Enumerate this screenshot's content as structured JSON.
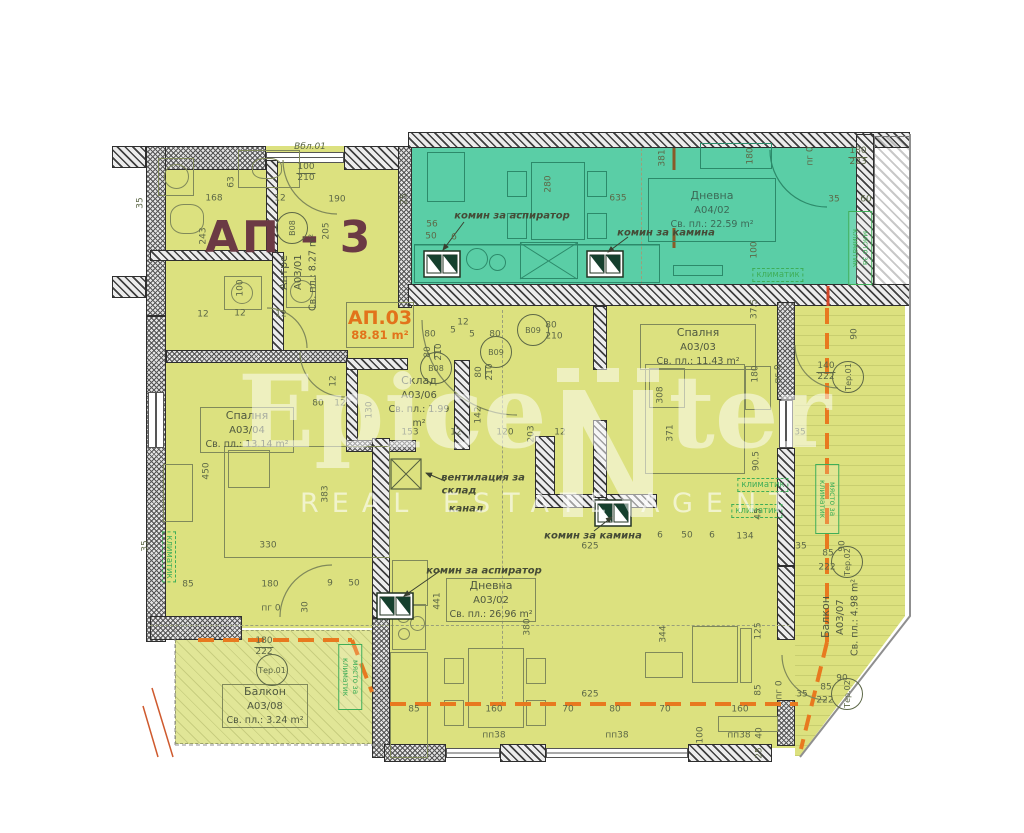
{
  "plan": {
    "building_label": "АП - 3",
    "unit_box": {
      "id": "АП.03",
      "area": "88.81 m²"
    },
    "rooms": [
      {
        "name": "Дневна",
        "code": "A04/02",
        "area": "Св. пл.: 22.59 m²"
      },
      {
        "name": "Антре",
        "code": "A03/01",
        "area": "Св. пл.: 8.27 m²"
      },
      {
        "name": "Спалня",
        "code": "A03/04",
        "area": "Св. пл.: 13.14 m²"
      },
      {
        "name": "Спалня",
        "code": "A03/03",
        "area": "Св. пл.: 11.43 m²"
      },
      {
        "name": "Склад",
        "code": "A03/06",
        "area": "Св. пл.: 1.99 m²"
      },
      {
        "name": "Дневна",
        "code": "A03/02",
        "area": "Св. пл.: 26.96 m²"
      },
      {
        "name": "Балкон",
        "code": "A03/08",
        "area": "Св. пл.: 3.24 m²"
      },
      {
        "name": "Балкон",
        "code": "A03/07",
        "area": "Св. пл.: 4.98 m²"
      }
    ],
    "watermark": {
      "left": "Epice",
      "right": "ter",
      "sub": "REAL ESTATE AGENT"
    },
    "colors": {
      "unit_fill": "#dce17f",
      "neighbor_fill": "#5acea6",
      "boundary_orange": "#e8791f",
      "unit_label_orange": "#e2731b",
      "title_maroon": "#6b3a44",
      "annotation_green": "#3fae58"
    },
    "notes": [
      {
        "t": "комин за аспиратор",
        "x": 512,
        "y": 216,
        "k": "ann"
      },
      {
        "t": "комин за камина",
        "x": 666,
        "y": 233,
        "k": "ann"
      },
      {
        "t": "комин за камина",
        "x": 593,
        "y": 536,
        "k": "ann"
      },
      {
        "t": "комин за аспиратор",
        "x": 484,
        "y": 571,
        "k": "ann"
      },
      {
        "t": "вентилация за",
        "x": 483,
        "y": 478,
        "k": "ann"
      },
      {
        "t": "склад",
        "x": 459,
        "y": 491,
        "k": "ann"
      },
      {
        "t": "канал",
        "x": 466,
        "y": 509,
        "k": "ann"
      },
      {
        "t": "климатик",
        "x": 778,
        "y": 275,
        "k": "klim"
      },
      {
        "t": "климатик",
        "x": 763,
        "y": 485,
        "k": "klim"
      },
      {
        "t": "климатик",
        "x": 757,
        "y": 511,
        "k": "klim"
      },
      {
        "t": "климатик",
        "x": 169,
        "y": 557,
        "k": "klimv"
      },
      {
        "t": "място за климатик",
        "x": 860,
        "y": 248,
        "k": "mqsto",
        "h": 68
      },
      {
        "t": "място за климатик",
        "x": 827,
        "y": 499,
        "k": "mqsto",
        "h": 64
      },
      {
        "t": "място за климатик",
        "x": 350,
        "y": 677,
        "k": "mqsto",
        "h": 60
      }
    ],
    "markers": [
      {
        "t": "Вбл.01",
        "x": 310,
        "y": 147,
        "p": 1
      },
      {
        "t": "B08",
        "x": 292,
        "y": 228,
        "c": 1,
        "v": 1
      },
      {
        "t": "B08",
        "x": 436,
        "y": 368,
        "c": 1
      },
      {
        "t": "B09",
        "x": 533,
        "y": 330,
        "c": 1
      },
      {
        "t": "B09",
        "x": 496,
        "y": 352,
        "c": 1
      },
      {
        "t": "Тер.01",
        "x": 848,
        "y": 377,
        "c": 1,
        "v": 1
      },
      {
        "t": "Тер.01",
        "x": 272,
        "y": 670,
        "c": 1
      },
      {
        "t": "Тер.02",
        "x": 847,
        "y": 562,
        "c": 1,
        "v": 1
      },
      {
        "t": "Тер.02",
        "x": 847,
        "y": 694,
        "c": 1,
        "v": 1
      }
    ],
    "dims": [
      {
        "t": "35",
        "x": 141,
        "y": 203,
        "v": 1
      },
      {
        "t": "168",
        "x": 214,
        "y": 199
      },
      {
        "t": "63",
        "x": 232,
        "y": 182,
        "v": 1
      },
      {
        "t": "12",
        "x": 280,
        "y": 199
      },
      {
        "t": "100",
        "t2": "210",
        "x": 306,
        "y": 173
      },
      {
        "t": "190",
        "x": 337,
        "y": 200
      },
      {
        "t": "205",
        "x": 327,
        "y": 231,
        "v": 1
      },
      {
        "t": "243",
        "x": 204,
        "y": 236,
        "v": 1
      },
      {
        "t": "100",
        "x": 241,
        "y": 288,
        "v": 1
      },
      {
        "t": "12",
        "x": 203,
        "y": 315
      },
      {
        "t": "12",
        "x": 240,
        "y": 314
      },
      {
        "t": "12",
        "x": 281,
        "y": 315
      },
      {
        "t": "25",
        "x": 405,
        "y": 199,
        "v": 1
      },
      {
        "t": "381",
        "x": 663,
        "y": 158,
        "v": 1
      },
      {
        "t": "280",
        "x": 549,
        "y": 184,
        "v": 1
      },
      {
        "t": "635",
        "x": 618,
        "y": 199
      },
      {
        "t": "180",
        "x": 751,
        "y": 156,
        "v": 1
      },
      {
        "t": "пг 0",
        "x": 811,
        "y": 156,
        "v": 1
      },
      {
        "t": "180",
        "t2": "223",
        "x": 858,
        "y": 157
      },
      {
        "t": "35",
        "x": 834,
        "y": 200
      },
      {
        "t": "60",
        "x": 866,
        "y": 200
      },
      {
        "t": "100",
        "x": 755,
        "y": 250,
        "v": 1
      },
      {
        "t": "56",
        "x": 432,
        "y": 225
      },
      {
        "t": "50",
        "x": 431,
        "y": 237
      },
      {
        "t": "6",
        "x": 454,
        "y": 238
      },
      {
        "t": "12",
        "x": 463,
        "y": 323
      },
      {
        "t": "80",
        "x": 430,
        "y": 335
      },
      {
        "t": "5",
        "x": 453,
        "y": 331
      },
      {
        "t": "5",
        "x": 472,
        "y": 335
      },
      {
        "t": "80",
        "x": 495,
        "y": 335
      },
      {
        "t": "80",
        "x": 551,
        "y": 326
      },
      {
        "t": "210",
        "x": 554,
        "y": 337
      },
      {
        "t": "80",
        "t2": "210",
        "x": 434,
        "y": 352,
        "v": 1
      },
      {
        "t": "80",
        "t2": "210",
        "x": 485,
        "y": 372,
        "v": 1
      },
      {
        "t": "130",
        "x": 370,
        "y": 410,
        "v": 1
      },
      {
        "t": "153",
        "x": 410,
        "y": 433
      },
      {
        "t": "12",
        "x": 456,
        "y": 433
      },
      {
        "t": "120",
        "x": 505,
        "y": 433
      },
      {
        "t": "203",
        "x": 532,
        "y": 434,
        "v": 1
      },
      {
        "t": "12",
        "x": 560,
        "y": 433
      },
      {
        "t": "142",
        "x": 479,
        "y": 415,
        "v": 1
      },
      {
        "t": "12",
        "x": 334,
        "y": 381,
        "v": 1
      },
      {
        "t": "80",
        "x": 318,
        "y": 404
      },
      {
        "t": "12",
        "x": 340,
        "y": 404
      },
      {
        "t": "37.5",
        "x": 755,
        "y": 309,
        "v": 1
      },
      {
        "t": "308",
        "x": 661,
        "y": 395,
        "v": 1
      },
      {
        "t": "371",
        "x": 671,
        "y": 433,
        "v": 1
      },
      {
        "t": "180",
        "x": 756,
        "y": 374,
        "v": 1
      },
      {
        "t": "90.5",
        "x": 757,
        "y": 461,
        "v": 1
      },
      {
        "t": "пг 0",
        "x": 779,
        "y": 374,
        "v": 1
      },
      {
        "t": "140",
        "t2": "222",
        "x": 826,
        "y": 372
      },
      {
        "t": "90",
        "x": 855,
        "y": 334,
        "v": 1
      },
      {
        "t": "35",
        "x": 800,
        "y": 433
      },
      {
        "t": "450",
        "x": 207,
        "y": 471,
        "v": 1
      },
      {
        "t": "383",
        "x": 326,
        "y": 494,
        "v": 1
      },
      {
        "t": "330",
        "x": 268,
        "y": 546
      },
      {
        "t": "85",
        "x": 188,
        "y": 585
      },
      {
        "t": "180",
        "x": 270,
        "y": 585
      },
      {
        "t": "9",
        "x": 330,
        "y": 584
      },
      {
        "t": "50",
        "x": 354,
        "y": 584
      },
      {
        "t": "35",
        "x": 146,
        "y": 546,
        "v": 1
      },
      {
        "t": "441",
        "x": 438,
        "y": 601,
        "v": 1
      },
      {
        "t": "380",
        "x": 528,
        "y": 627,
        "v": 1
      },
      {
        "t": "пг 0",
        "x": 271,
        "y": 609
      },
      {
        "t": "30",
        "x": 306,
        "y": 607,
        "v": 1
      },
      {
        "t": "180",
        "t2": "222",
        "x": 264,
        "y": 647
      },
      {
        "t": "625",
        "x": 590,
        "y": 547
      },
      {
        "t": "6",
        "x": 660,
        "y": 536
      },
      {
        "t": "50",
        "x": 687,
        "y": 536
      },
      {
        "t": "6",
        "x": 712,
        "y": 536
      },
      {
        "t": "134",
        "x": 745,
        "y": 537
      },
      {
        "t": "45",
        "x": 759,
        "y": 514,
        "v": 1
      },
      {
        "t": "625",
        "x": 590,
        "y": 695
      },
      {
        "t": "85",
        "x": 414,
        "y": 710
      },
      {
        "t": "160",
        "x": 494,
        "y": 710
      },
      {
        "t": "70",
        "x": 568,
        "y": 710
      },
      {
        "t": "80",
        "x": 615,
        "y": 710
      },
      {
        "t": "70",
        "x": 665,
        "y": 710
      },
      {
        "t": "160",
        "x": 740,
        "y": 710
      },
      {
        "t": "пп38",
        "x": 494,
        "y": 736
      },
      {
        "t": "пп38",
        "x": 617,
        "y": 736
      },
      {
        "t": "пп38",
        "x": 739,
        "y": 736
      },
      {
        "t": "344",
        "x": 664,
        "y": 634,
        "v": 1
      },
      {
        "t": "100",
        "x": 701,
        "y": 735,
        "v": 1
      },
      {
        "t": "40",
        "x": 760,
        "y": 733,
        "v": 1
      },
      {
        "t": "25",
        "x": 760,
        "y": 753,
        "v": 1
      },
      {
        "t": "125",
        "x": 759,
        "y": 631,
        "v": 1
      },
      {
        "t": "85",
        "x": 759,
        "y": 690,
        "v": 1
      },
      {
        "t": "пг 0",
        "x": 780,
        "y": 690,
        "v": 1
      },
      {
        "t": "90",
        "x": 843,
        "y": 546,
        "v": 1
      },
      {
        "t": "85",
        "x": 828,
        "y": 554
      },
      {
        "t": "222",
        "x": 827,
        "y": 568
      },
      {
        "t": "35",
        "x": 801,
        "y": 547
      },
      {
        "t": "90",
        "x": 842,
        "y": 679
      },
      {
        "t": "85",
        "x": 826,
        "y": 688
      },
      {
        "t": "222",
        "x": 825,
        "y": 701
      },
      {
        "t": "35",
        "x": 802,
        "y": 695
      }
    ]
  }
}
